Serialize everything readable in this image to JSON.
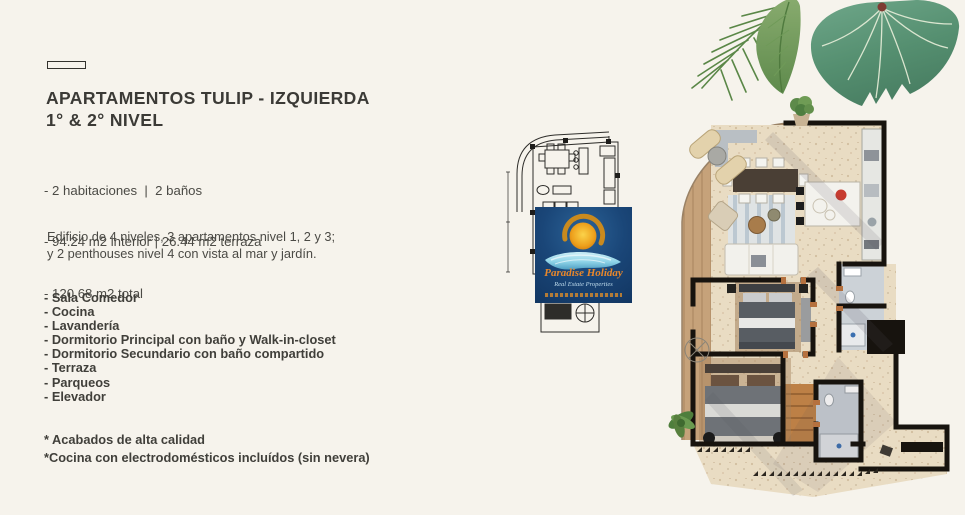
{
  "page": {
    "background_color": "#f6f3ec",
    "accent_wall_color": "#17130e",
    "floor_color": "#e9dcc4",
    "deck_color": "#c6a37b"
  },
  "heading": {
    "line1": "APARTAMENTOS TULIP - IZQUIERDA",
    "line2": "1° & 2° NIVEL"
  },
  "specs": [
    "- 2 habitaciones  |  2 baños",
    "- 94.24 m2 interior | 26.44 m2 terraza",
    "- 120.68 m2 total"
  ],
  "building_description": [
    "Edificio de 4 niveles, 3 apartamentos nivel 1, 2 y 3;",
    "y 2 penthouses nivel 4 con vista al mar y jardín."
  ],
  "features": [
    "- Sala Comedor",
    "- Cocina",
    "- Lavandería",
    "- Dormitorio Principal con baño y Walk-in-closet",
    "- Dormitorio Secundario con baño compartido",
    "- Terraza",
    "- Parqueos",
    "- Elevador"
  ],
  "notes": [
    "* Acabados de alta calidad",
    "*Cocina con electrodomésticos incluídos (sin nevera)"
  ],
  "watermark_logo": {
    "brand": "Paradise Holiday",
    "tagline": "Real Estate Properties",
    "background_color": "#1a4678",
    "sun_color": "#f2a71f",
    "wave_color": "#8fd4e8",
    "brand_text_color": "#e8872b"
  }
}
